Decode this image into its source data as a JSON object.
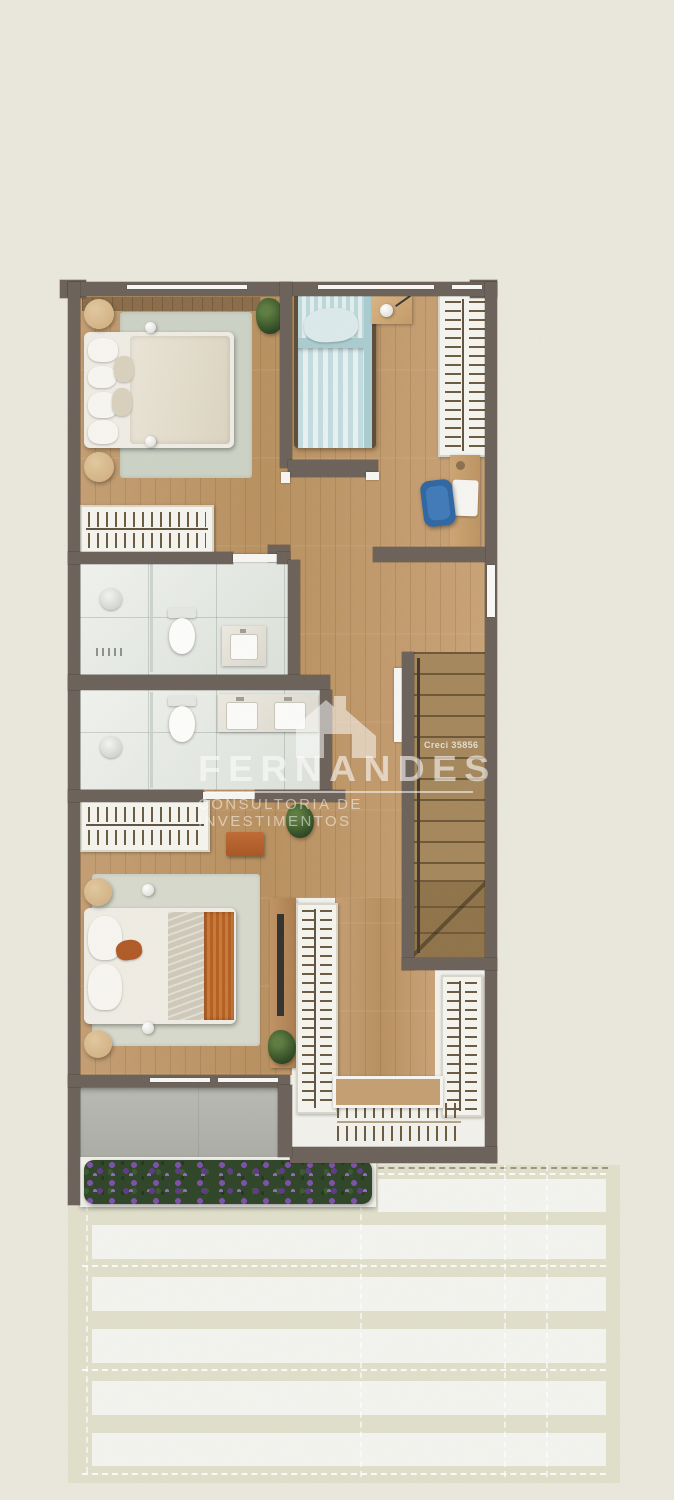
{
  "watermark": {
    "brand": "FERNANDES",
    "subtitle": "CONSULTORIA DE INVESTIMENTOS",
    "license": "Creci 35856",
    "icon": "house-roof-icon",
    "text_color": "#ffffff"
  },
  "palette": {
    "page_background": "#eae8dc",
    "wall": "#6b6159",
    "wood_floor": "#c29b6e",
    "bathroom_tile": "#e9ece7",
    "rug_sage": "#ccd2c5",
    "rug_light": "#d7d9cc",
    "bed_blue": "#bfdbdd",
    "throw_orange": "#b45f24",
    "chair_blue": "#2e66a3",
    "balcony_concrete": "#b4b5ae",
    "pergola_base": "#e0dfca",
    "pergola_slat": "#f3f4ef",
    "flowers_purple": "#7b50a8",
    "flowers_green": "#2e4427"
  },
  "floor_plan": {
    "type": "residential-upper-floor-plan-top-view",
    "rooms": [
      {
        "name": "bedroom-1",
        "furniture": [
          "double-bed",
          "area-rug",
          "round-nightstand",
          "round-nightstand",
          "table-lamp",
          "hanger-wardrobe",
          "potted-plant",
          "headboard-panel"
        ]
      },
      {
        "name": "bedroom-2",
        "furniture": [
          "single-bed-blue",
          "nightstand",
          "table-lamp",
          "hanger-wardrobe",
          "desk",
          "laptop",
          "blue-office-chair"
        ]
      },
      {
        "name": "bathroom-1",
        "furniture": [
          "walk-in-shower",
          "toilet",
          "single-sink-vanity",
          "glass-partition"
        ]
      },
      {
        "name": "bathroom-2",
        "furniture": [
          "walk-in-shower",
          "toilet",
          "double-sink-vanity",
          "glass-partition",
          "towel-rail"
        ]
      },
      {
        "name": "hallway",
        "furniture": [
          "door-leaf",
          "door-leaf"
        ]
      },
      {
        "name": "staircase",
        "furniture": [
          "upper-flight-treads",
          "winder-landing",
          "handrail"
        ]
      },
      {
        "name": "bedroom-3-master",
        "furniture": [
          "double-bed-orange-throw",
          "area-rug",
          "round-nightstand",
          "round-nightstand",
          "table-lamp",
          "hanger-wardrobe",
          "bench-orange",
          "tv-sideboard",
          "tv-panel",
          "potted-plant",
          "potted-plant"
        ]
      },
      {
        "name": "walk-in-closet",
        "furniture": [
          "hanger-rack-left",
          "hanger-rack-right",
          "hanger-rack-bottom",
          "island-bench"
        ]
      },
      {
        "name": "balcony",
        "furniture": [
          "concrete-deck",
          "flower-planter-purple"
        ]
      },
      {
        "name": "pergola-terrace",
        "furniture": [
          "roof-slats",
          "dashed-projection-lines"
        ]
      }
    ],
    "window_count": 6,
    "orientation": "vertical-lot"
  }
}
